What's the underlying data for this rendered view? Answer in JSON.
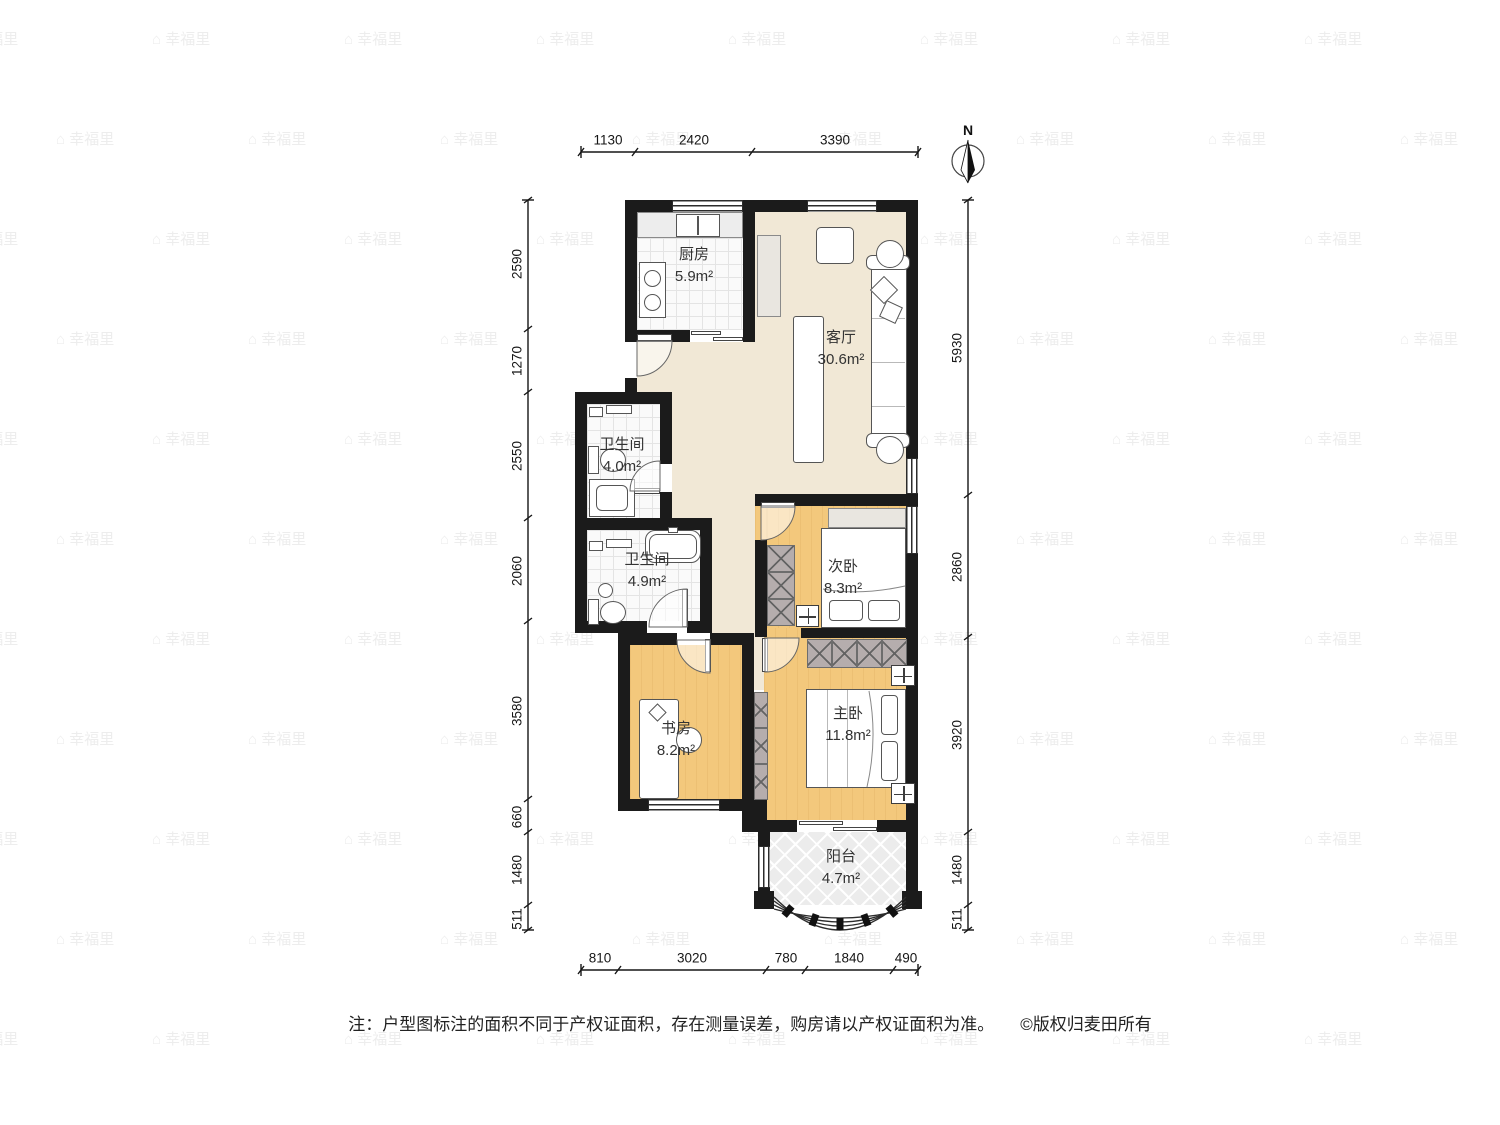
{
  "compass": {
    "label": "N"
  },
  "watermark": {
    "text": "幸福里"
  },
  "note": {
    "prefix": "注：户型图标注的面积不同于产权证面积，存在测量误差，购房请以产权证面积为准。",
    "copyright": "©版权归麦田所有"
  },
  "colors": {
    "wall": "#1b1b1b",
    "floor_beige": "#f1e8d6",
    "floor_wood": "#f3c87c",
    "floor_tile": "#fafafa",
    "balcony_floor": "#ececec",
    "wardrobe_fill": "#b5adad"
  },
  "rooms": [
    {
      "id": "kitchen",
      "name": "厨房",
      "area": "5.9m²"
    },
    {
      "id": "living",
      "name": "客厅",
      "area": "30.6m²"
    },
    {
      "id": "bath1",
      "name": "卫生间",
      "area": "4.0m²"
    },
    {
      "id": "bath2",
      "name": "卫生间",
      "area": "4.9m²"
    },
    {
      "id": "bedroom2",
      "name": "次卧",
      "area": "8.3m²"
    },
    {
      "id": "study",
      "name": "书房",
      "area": "8.2m²"
    },
    {
      "id": "master",
      "name": "主卧",
      "area": "11.8m²"
    },
    {
      "id": "balcony",
      "name": "阳台",
      "area": "4.7m²"
    }
  ],
  "dimensions": {
    "top": [
      "1130",
      "2420",
      "3390"
    ],
    "bottom": [
      "810",
      "3020",
      "780",
      "1840",
      "490"
    ],
    "left": [
      "2590",
      "1270",
      "2550",
      "2060",
      "3580",
      "660",
      "1480",
      "511"
    ],
    "right": [
      "5930",
      "2860",
      "3920",
      "1480",
      "511"
    ]
  }
}
